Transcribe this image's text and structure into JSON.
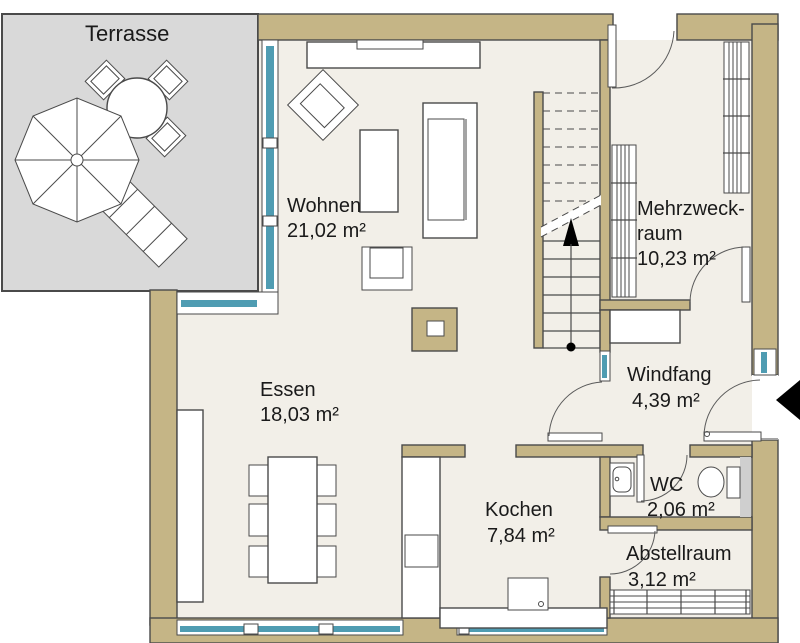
{
  "rooms": {
    "terrasse": {
      "name": "Terrasse"
    },
    "wohnen": {
      "name": "Wohnen",
      "area": "21,02 m²"
    },
    "essen": {
      "name": "Essen",
      "area": "18,03 m²"
    },
    "mehrzweckraum": {
      "name_line1": "Mehrzweck-",
      "name_line2": "raum",
      "area": "10,23 m²"
    },
    "windfang": {
      "name": "Windfang",
      "area": "4,39 m²"
    },
    "wc": {
      "name": "WC",
      "area": "2,06 m²"
    },
    "kochen": {
      "name": "Kochen",
      "area": "7,84 m²"
    },
    "abstellraum": {
      "name": "Abstellraum",
      "area": "3,12 m²"
    }
  },
  "colors": {
    "wall": "#c5b586",
    "floor": "#f2efe8",
    "terrace": "#d9d9d9",
    "glass": "#4f9cb2",
    "line": "#4a4a4a",
    "text": "#1a1a1a",
    "fixture": "#cfcfcf",
    "arrow": "#000000"
  }
}
